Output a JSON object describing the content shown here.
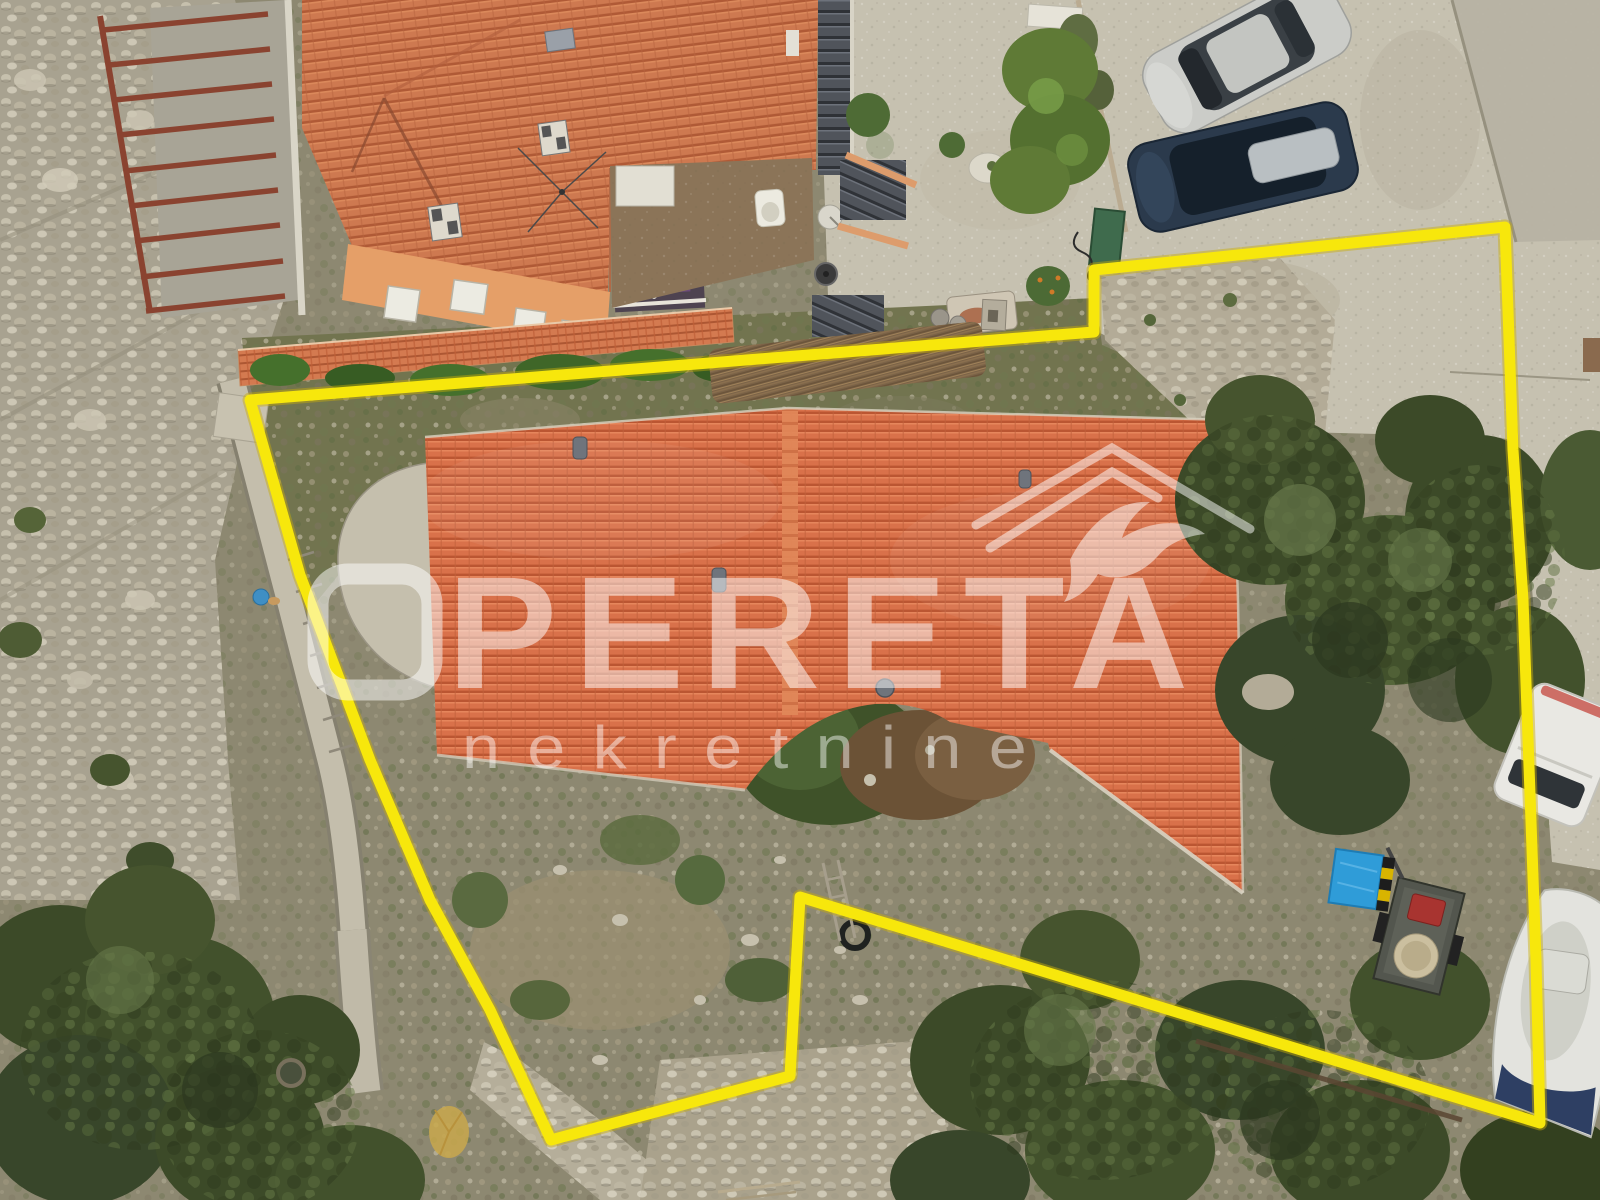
{
  "watermark": {
    "title": "PERETA",
    "subtitle": "nekretnine",
    "logo": "roof-outline-with-swallow",
    "color": "#FFFFFF"
  },
  "boundary": {
    "color": "#F7E70C",
    "path": "M1505,227 L1094,270 L1094,332 L250,400 L300,575 L370,760 L430,900 L490,1010 L551,1140 L790,1076 L800,897 L1540,1123 L1536,960 L1523,600 L1513,450 L1505,227 Z"
  },
  "palette": {
    "roof_tile": "#D9714A",
    "upper_roof": "#CE7950",
    "concrete": "#C6C1B0",
    "road": "#B7B2A3",
    "scrub": "#8D8871",
    "rock": "#A8A290",
    "tree_dark": "#33401F",
    "tree_light": "#5D7040",
    "tarp_blue": "#2F9CD8",
    "crate_red": "#A83430"
  }
}
